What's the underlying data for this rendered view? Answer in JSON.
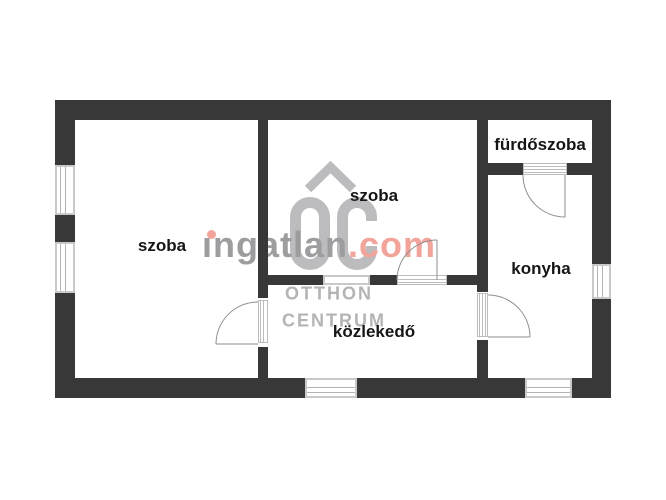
{
  "rooms": [
    {
      "id": "szoba-left",
      "label": "szoba"
    },
    {
      "id": "szoba-middle",
      "label": "szoba"
    },
    {
      "id": "furdoszoba",
      "label": "fürdőszoba"
    },
    {
      "id": "konyha",
      "label": "konyha"
    },
    {
      "id": "kozlekedo",
      "label": "közlekedő"
    }
  ],
  "watermark": {
    "brand_main": "ıngatlan",
    "brand_tld": ".com",
    "logo_text_line1": "OTTHON",
    "logo_text_line2": "CENTRUM"
  },
  "colors": {
    "wall": "#383838",
    "window_frame": "#c9c9c9",
    "door_line": "#8f8f8f",
    "label_text": "#161616",
    "brand_gray": "#9d9da0",
    "brand_accent": "#f2a49a",
    "logo_gray": "#b4b4b6"
  }
}
